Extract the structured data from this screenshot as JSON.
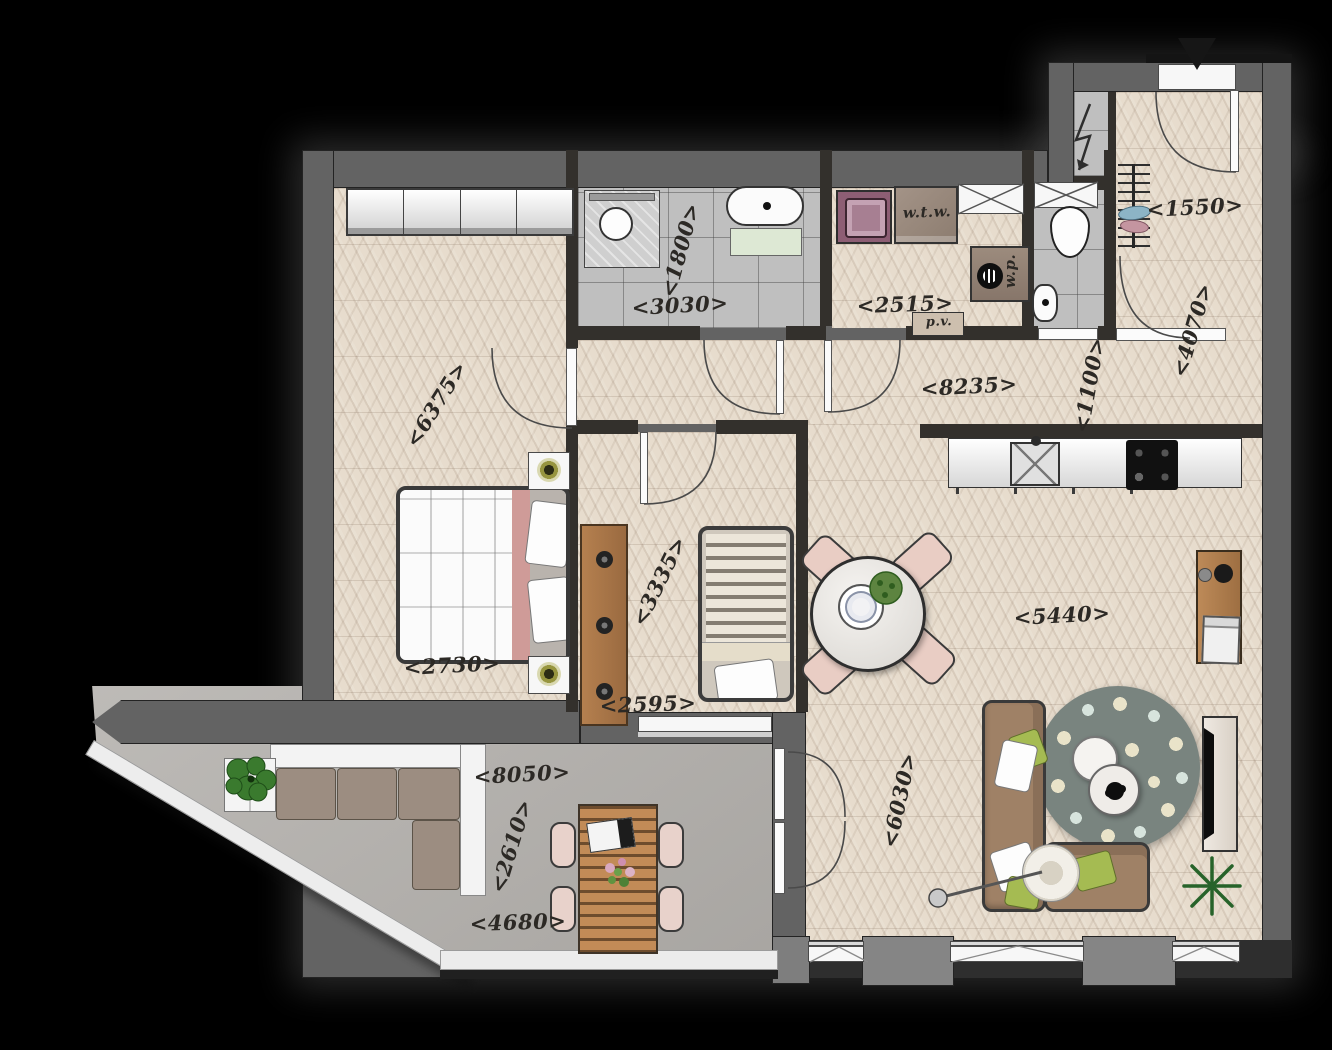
{
  "plan": {
    "kind": "apartment-floor-plan"
  },
  "colors": {
    "background": "#000000",
    "exterior_wall": "#636363",
    "interior_wall": "#33302c",
    "wood_floor": "#e7dccd",
    "tile_floor": "#bfbfbf",
    "terrace_concrete": "#b6b3af",
    "bed_accent_pink": "#cf9b98",
    "pillow_green": "#a5bb52",
    "sofa_brown": "#9f8166",
    "rug_gray": "#79847f",
    "furniture_wood": "#b5804f",
    "label_ink": "#2c2925"
  },
  "labels": [
    {
      "text": "<6375>",
      "room": "bedroom",
      "x": 436,
      "y": 404,
      "rot": -58
    },
    {
      "text": "<2730>",
      "room": "bedroom",
      "x": 452,
      "y": 665,
      "rot": -3
    },
    {
      "text": "<1800>",
      "room": "bathroom",
      "x": 680,
      "y": 250,
      "rot": -75
    },
    {
      "text": "<3030>",
      "room": "bathroom",
      "x": 680,
      "y": 305,
      "rot": -3
    },
    {
      "text": "<2515>",
      "room": "utility",
      "x": 905,
      "y": 304,
      "rot": -2
    },
    {
      "text": "w.t.w.",
      "room": "utility",
      "x": 927,
      "y": 212,
      "rot": -2,
      "size": 15,
      "kind": "equipment-label"
    },
    {
      "text": "w.p.",
      "room": "utility",
      "x": 1010,
      "y": 271,
      "rot": -90,
      "size": 15,
      "kind": "equipment-label"
    },
    {
      "text": "p.v.",
      "room": "utility",
      "x": 939,
      "y": 322,
      "rot": -2,
      "size": 13,
      "kind": "equipment-label"
    },
    {
      "text": "<8235>",
      "room": "hall",
      "x": 969,
      "y": 386,
      "rot": -3
    },
    {
      "text": "<1100>",
      "room": "hall",
      "x": 1089,
      "y": 385,
      "rot": -80
    },
    {
      "text": "<4070>",
      "room": "hall",
      "x": 1192,
      "y": 330,
      "rot": -74
    },
    {
      "text": "<1550>",
      "room": "entry",
      "x": 1195,
      "y": 207,
      "rot": -3
    },
    {
      "text": "<3335>",
      "room": "bedroom-2",
      "x": 659,
      "y": 581,
      "rot": -64
    },
    {
      "text": "<2595>",
      "room": "bedroom-2",
      "x": 648,
      "y": 704,
      "rot": -2
    },
    {
      "text": "<5440>",
      "room": "living-room",
      "x": 1062,
      "y": 615,
      "rot": -3
    },
    {
      "text": "<6030>",
      "room": "living-room",
      "x": 899,
      "y": 800,
      "rot": -78
    },
    {
      "text": "<8050>",
      "room": "terrace",
      "x": 522,
      "y": 774,
      "rot": -3
    },
    {
      "text": "<2610>",
      "room": "terrace",
      "x": 511,
      "y": 846,
      "rot": -73
    },
    {
      "text": "<4680>",
      "room": "terrace",
      "x": 518,
      "y": 922,
      "rot": -2
    }
  ]
}
